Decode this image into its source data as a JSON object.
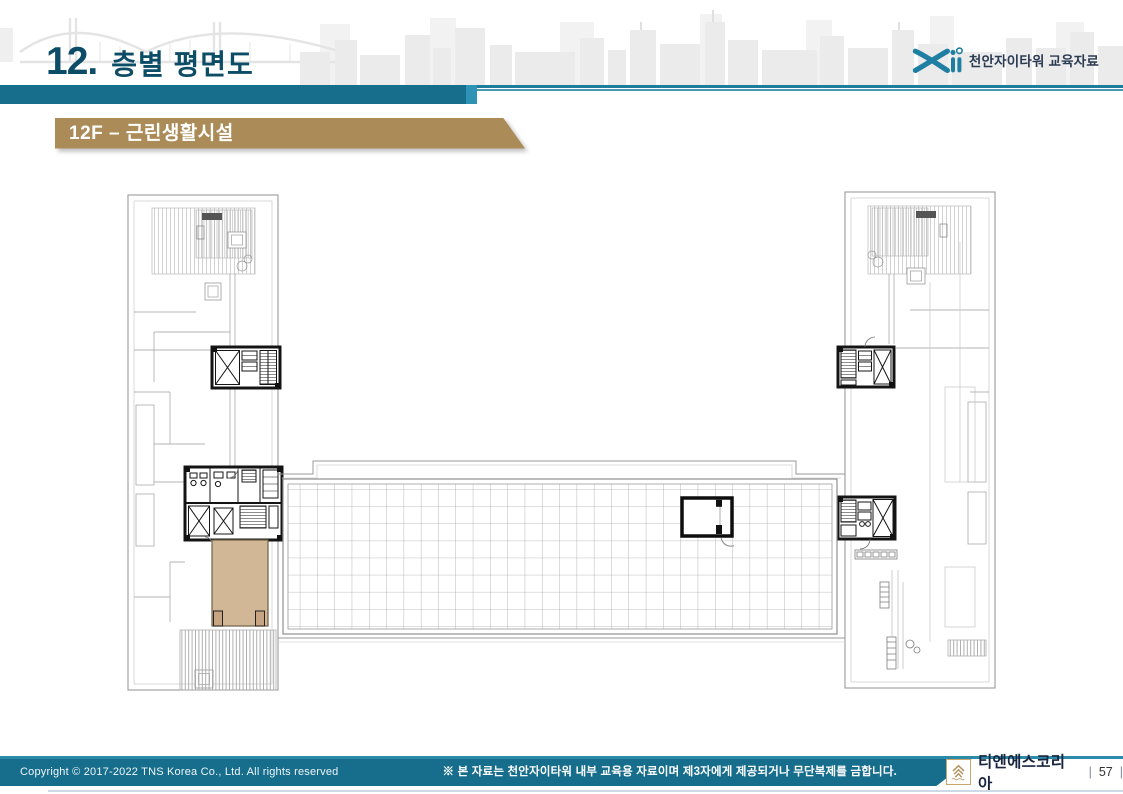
{
  "header": {
    "number": "12.",
    "title": "층별 평면도",
    "brand": "천안자이타워 교육자료"
  },
  "section": {
    "label": "12F – 근린생활시설"
  },
  "footer": {
    "copyright": "Copyright © 2017-2022 TNS Korea Co., Ltd.  All rights reserved",
    "notice": "※ 본 자료는 천안자이타워 내부 교육용 자료이며 제3자에게 제공되거나 무단복제를 금합니다.",
    "company": "티엔에스코리아",
    "page": "57",
    "separator": "|"
  },
  "icons": {
    "brand_logo": "xi-logo",
    "footer_emblem": "tns-mountain-emblem"
  },
  "colors": {
    "title_text": "#0d4c67",
    "teal_bar": "#176e8c",
    "teal_accent": "#2e93b4",
    "tan_label": "#ab8c58",
    "footer_bar": "#176e8c",
    "room_highlight": "#d2b797"
  }
}
